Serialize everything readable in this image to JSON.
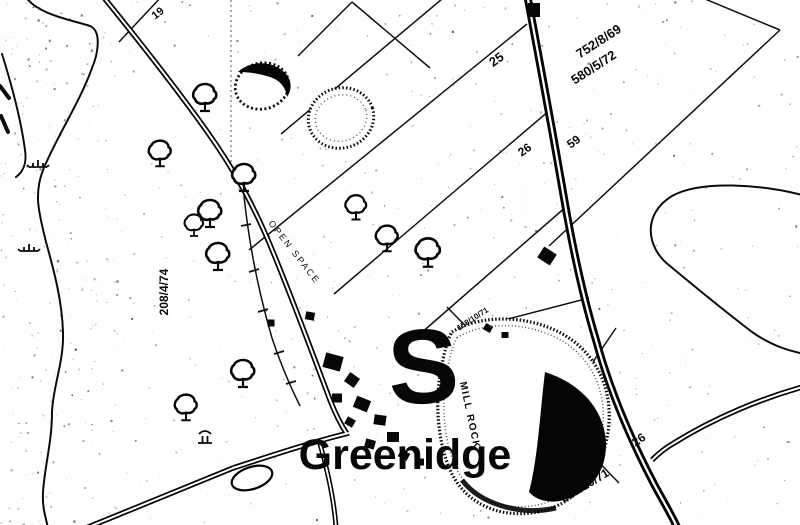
{
  "map": {
    "place_name": "Greenidge",
    "ink_color": "#101010",
    "paper_color": "#ffffff",
    "labels": [
      {
        "id": "plot-19",
        "text": "19",
        "x": 160,
        "y": 16,
        "rot": -38,
        "size": 11,
        "weight": 700
      },
      {
        "id": "plot-25",
        "text": "25",
        "x": 499,
        "y": 63,
        "rot": -36,
        "size": 13,
        "weight": 700
      },
      {
        "id": "ref-752-8-69",
        "text": "752/8/69",
        "x": 601,
        "y": 45,
        "rot": -33,
        "size": 13,
        "weight": 700
      },
      {
        "id": "ref-580-5-72",
        "text": "580/5/72",
        "x": 596,
        "y": 71,
        "rot": -33,
        "size": 13,
        "weight": 700
      },
      {
        "id": "plot-26-upper",
        "text": "26",
        "x": 527,
        "y": 153,
        "rot": -36,
        "size": 12,
        "weight": 700
      },
      {
        "id": "plot-59",
        "text": "59",
        "x": 576,
        "y": 145,
        "rot": -36,
        "size": 12,
        "weight": 700
      },
      {
        "id": "ref-208-4-74",
        "text": "208/4/74",
        "x": 168,
        "y": 292,
        "rot": -90,
        "size": 12,
        "weight": 700
      },
      {
        "id": "open-space",
        "text": "OPEN SPACE",
        "x": 292,
        "y": 254,
        "rot": 52,
        "size": 9,
        "weight": 400,
        "spacing": 2
      },
      {
        "id": "ref-158-10-71",
        "text": "158/10/71",
        "x": 474,
        "y": 321,
        "rot": -33,
        "size": 8,
        "weight": 700
      },
      {
        "id": "mill-rock",
        "text": "MILL ROCK",
        "x": 467,
        "y": 416,
        "rot": 78,
        "size": 10,
        "weight": 700,
        "spacing": 1.5
      },
      {
        "id": "plot-26-lower",
        "text": "26",
        "x": 641,
        "y": 443,
        "rot": -35,
        "size": 12,
        "weight": 700
      },
      {
        "id": "ref-857-10-71",
        "text": "857/10/71",
        "x": 587,
        "y": 489,
        "rot": -31,
        "size": 12,
        "weight": 700
      },
      {
        "id": "big-letter-s",
        "text": "S",
        "x": 425,
        "y": 403,
        "rot": -3,
        "size": 106,
        "weight": 700,
        "serif": true
      },
      {
        "id": "settlement-name",
        "text": "Greenidge",
        "x": 405,
        "y": 469,
        "rot": 0,
        "size": 43,
        "weight": 700
      }
    ],
    "features": {
      "trees": [
        {
          "x": 205,
          "y": 96,
          "s": 1
        },
        {
          "x": 160,
          "y": 152,
          "s": 0.95
        },
        {
          "x": 244,
          "y": 176,
          "s": 1
        },
        {
          "x": 210,
          "y": 212,
          "s": 1
        },
        {
          "x": 194,
          "y": 224,
          "s": 0.8
        },
        {
          "x": 218,
          "y": 255,
          "s": 1
        },
        {
          "x": 356,
          "y": 206,
          "s": 0.9
        },
        {
          "x": 387,
          "y": 237,
          "s": 0.95
        },
        {
          "x": 428,
          "y": 251,
          "s": 1.05
        },
        {
          "x": 243,
          "y": 372,
          "s": 1
        },
        {
          "x": 186,
          "y": 406,
          "s": 0.95
        }
      ],
      "buildings": [
        [
          534,
          10,
          12,
          14,
          0
        ],
        [
          547,
          256,
          15,
          13,
          33
        ],
        [
          310,
          316,
          9,
          8,
          10
        ],
        [
          271,
          323,
          7,
          7,
          0
        ],
        [
          333,
          362,
          18,
          15,
          15
        ],
        [
          352,
          380,
          12,
          11,
          35
        ],
        [
          337,
          398,
          10,
          9,
          0
        ],
        [
          362,
          404,
          15,
          12,
          22
        ],
        [
          380,
          420,
          12,
          10,
          8
        ],
        [
          350,
          422,
          9,
          8,
          30
        ],
        [
          393,
          437,
          12,
          10,
          0
        ],
        [
          370,
          444,
          10,
          9,
          15
        ],
        [
          404,
          455,
          10,
          8,
          28
        ],
        [
          420,
          462,
          8,
          7,
          0
        ],
        [
          488,
          328,
          8,
          7,
          30
        ],
        [
          505,
          335,
          7,
          6,
          0
        ]
      ],
      "marsh": [
        [
          38,
          167
        ],
        [
          29,
          251
        ]
      ],
      "ruins": [
        [
          205,
          437
        ]
      ]
    }
  }
}
